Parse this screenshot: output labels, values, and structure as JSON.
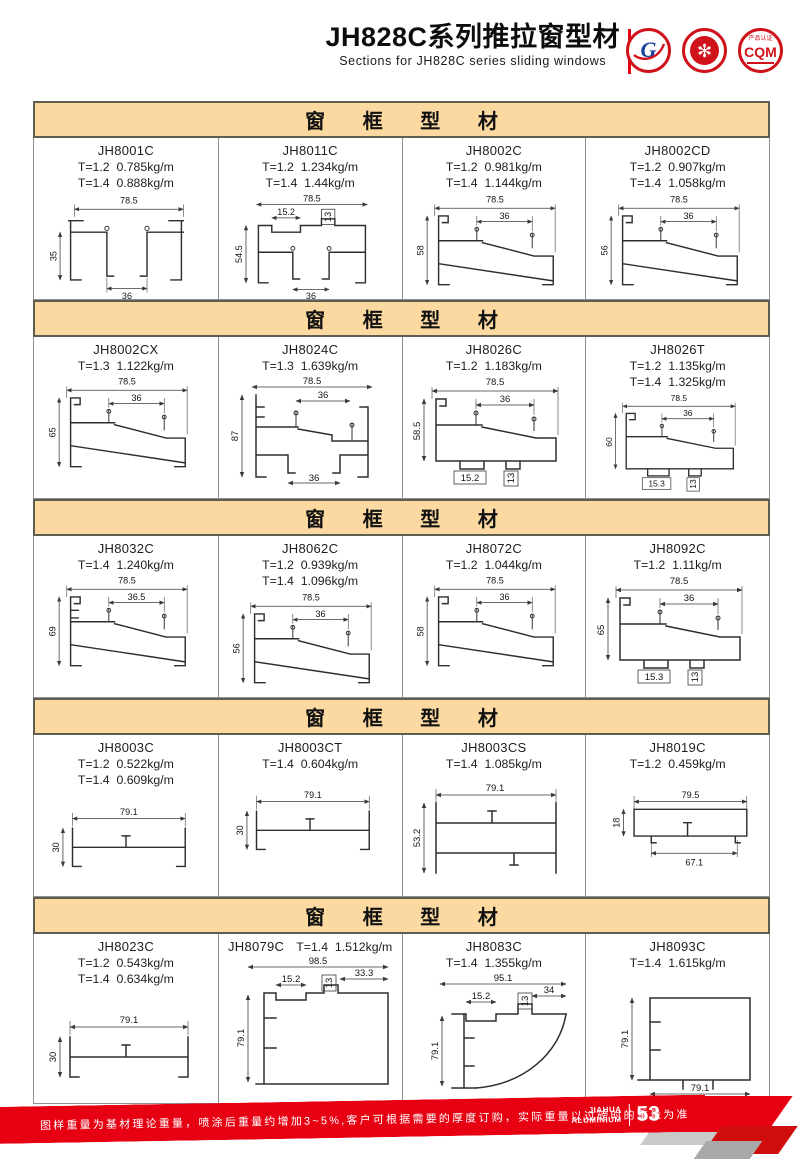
{
  "header": {
    "title": "JH828C系列推拉窗型材",
    "subtitle": "Sections for JH828C series sliding windows",
    "logos": {
      "gb_letter": "G",
      "seal_glyph": "✻",
      "cqm_top": "产品认证",
      "cqm_text": "CQM"
    }
  },
  "sections": [
    {
      "title": "窗 框 型 材",
      "cells": [
        {
          "code": "JH8001C",
          "weights": [
            "T=1.2  0.785kg/m",
            "T=1.4  0.888kg/m"
          ],
          "dims": {
            "w": "78.5",
            "h": "35",
            "a": "36"
          }
        },
        {
          "code": "JH8011C",
          "weights": [
            "T=1.2  1.234kg/m",
            "T=1.4  1.44kg/m"
          ],
          "dims": {
            "w": "78.5",
            "s1": "15.2",
            "s2": "13",
            "h": "54.5",
            "a": "36"
          }
        },
        {
          "code": "JH8002C",
          "weights": [
            "T=1.2  0.981kg/m",
            "T=1.4  1.144kg/m"
          ],
          "dims": {
            "w": "78.5",
            "a": "36",
            "h": "58"
          }
        },
        {
          "code": "JH8002CD",
          "weights": [
            "T=1.2  0.907kg/m",
            "T=1.4  1.058kg/m"
          ],
          "dims": {
            "w": "78.5",
            "a": "36",
            "h": "56"
          }
        }
      ]
    },
    {
      "title": "窗 框 型 材",
      "cells": [
        {
          "code": "JH8002CX",
          "weights": [
            "T=1.3  1.122kg/m"
          ],
          "dims": {
            "w": "78.5",
            "a": "36",
            "h": "65"
          }
        },
        {
          "code": "JH8024C",
          "weights": [
            "T=1.3  1.639kg/m"
          ],
          "dims": {
            "w": "78.5",
            "a": "36",
            "h": "87",
            "b": "36"
          }
        },
        {
          "code": "JH8026C",
          "weights": [
            "T=1.2  1.183kg/m"
          ],
          "dims": {
            "w": "78.5",
            "a": "36",
            "h": "58.5",
            "t1": "15.2",
            "t2": "13"
          }
        },
        {
          "code": "JH8026T",
          "weights": [
            "T=1.2  1.135kg/m",
            "T=1.4  1.325kg/m"
          ],
          "dims": {
            "w": "78.5",
            "a": "36",
            "h": "60",
            "t1": "15.3",
            "t2": "13"
          }
        }
      ]
    },
    {
      "title": "窗 框 型 材",
      "cells": [
        {
          "code": "JH8032C",
          "weights": [
            "T=1.4  1.240kg/m"
          ],
          "dims": {
            "w": "78.5",
            "a": "36.5",
            "h": "69"
          }
        },
        {
          "code": "JH8062C",
          "weights": [
            "T=1.2  0.939kg/m",
            "T=1.4  1.096kg/m"
          ],
          "dims": {
            "w": "78.5",
            "a": "36",
            "h": "56"
          }
        },
        {
          "code": "JH8072C",
          "weights": [
            "T=1.2  1.044kg/m"
          ],
          "dims": {
            "w": "78.5",
            "a": "36",
            "h": "58"
          }
        },
        {
          "code": "JH8092C",
          "weights": [
            "T=1.2  1.11kg/m"
          ],
          "dims": {
            "w": "78.5",
            "a": "36",
            "h": "65",
            "t1": "15.3",
            "t2": "13"
          }
        }
      ]
    },
    {
      "title": "窗 框 型 材",
      "cells": [
        {
          "code": "JH8003C",
          "weights": [
            "T=1.2  0.522kg/m",
            "T=1.4  0.609kg/m"
          ],
          "dims": {
            "w": "79.1",
            "h": "30"
          }
        },
        {
          "code": "JH8003CT",
          "weights": [
            "T=1.4  0.604kg/m"
          ],
          "dims": {
            "w": "79.1",
            "h": "30"
          }
        },
        {
          "code": "JH8003CS",
          "weights": [
            "T=1.4  1.085kg/m"
          ],
          "dims": {
            "w": "79.1",
            "h": "53.2"
          }
        },
        {
          "code": "JH8019C",
          "weights": [
            "T=1.2  0.459kg/m"
          ],
          "dims": {
            "w": "79.5",
            "h": "18",
            "b": "67.1"
          }
        }
      ]
    },
    {
      "title": "窗 框 型 材",
      "cells": [
        {
          "code": "JH8023C",
          "weights": [
            "T=1.2  0.543kg/m",
            "T=1.4  0.634kg/m"
          ],
          "dims": {
            "w": "79.1",
            "h": "30"
          }
        },
        {
          "code": "JH8079C",
          "weights": [
            "T=1.4  1.512kg/m"
          ],
          "dims": {
            "w": "98.5",
            "s1": "33.3",
            "s2": "15.2",
            "s3": "13",
            "h": "79.1"
          }
        },
        {
          "code": "JH8083C",
          "weights": [
            "T=1.4  1.355kg/m"
          ],
          "dims": {
            "w": "95.1",
            "s1": "34",
            "s2": "15.2",
            "s3": "13",
            "h": "79.1"
          }
        },
        {
          "code": "JH8093C",
          "weights": [
            "T=1.4  1.615kg/m"
          ],
          "dims": {
            "h": "79.1",
            "b": "79.1"
          }
        }
      ]
    }
  ],
  "footer": {
    "note": "图样重量为基材理论重量，喷涂后重量约增加3~5%,客户可根据需要的厚度订购，实际重量以过磅时的重量为准。",
    "brand_line1": "JIAHUA",
    "brand_line2": "ALUMINIUM",
    "page_number": "53"
  },
  "colors": {
    "accent_red": "#e60012",
    "section_bar": "#fbd9a1",
    "border_dark": "#5e5e50",
    "line_gray": "#8f8f8f"
  }
}
